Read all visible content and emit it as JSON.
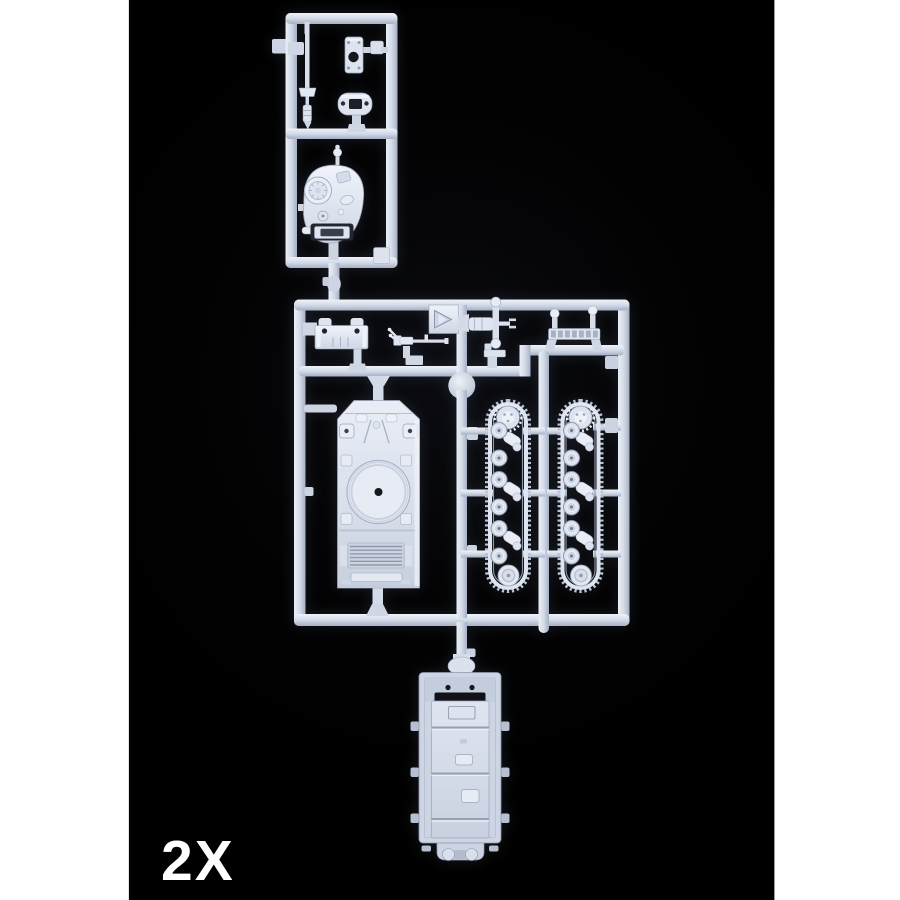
{
  "scene": {
    "type": "product-photograph",
    "subject": "injection-molded plastic sprue with 1/72 tank model parts on black background",
    "quantity_label": "2X"
  },
  "colors": {
    "page_background": "#ffffff",
    "photo_background": "#000000",
    "plastic_highlight": "#f0f4fa",
    "plastic_base": "#d3dbe8",
    "plastic_shadow": "#a3adc1",
    "label_text": "#ffffff"
  },
  "sprue": {
    "frames": [
      {
        "name": "top-sprue-frame"
      },
      {
        "name": "main-sprue-frame"
      }
    ],
    "parts": [
      {
        "name": "gun-barrel"
      },
      {
        "name": "hatch-ring-plate"
      },
      {
        "name": "mantlet-capsule"
      },
      {
        "name": "turret"
      },
      {
        "name": "hull-rear-plate"
      },
      {
        "name": "machine-gun"
      },
      {
        "name": "triangle-hatch-plate"
      },
      {
        "name": "gun-mount"
      },
      {
        "name": "small-bracket"
      },
      {
        "name": "tool-bar"
      },
      {
        "name": "upper-hull"
      },
      {
        "name": "left-track-assembly"
      },
      {
        "name": "right-track-assembly"
      },
      {
        "name": "lower-hull-tub"
      }
    ]
  }
}
